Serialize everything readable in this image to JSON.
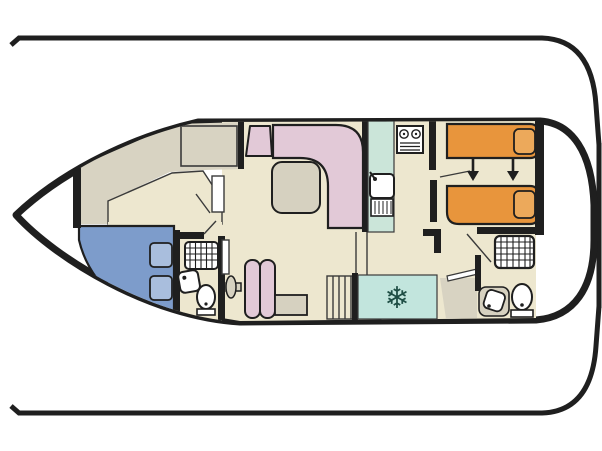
{
  "title": "boat-floor-plan",
  "colors": {
    "outline": "#1f1f1f",
    "wall": "#1f1f1f",
    "floor_cream": "#EDE7CF",
    "floor_grey": "#D8D3C2",
    "furniture_grey": "#D6D1C0",
    "bed_blue": "#7D9CCB",
    "pillow_blue": "#A9BEDD",
    "sofa_pink": "#E2C9D7",
    "bed_orange": "#E8953C",
    "pillow_orange": "#ECA95B",
    "galley_mint": "#CBE5D9",
    "fridge_cyan": "#C2E5DD",
    "snowflake_teal": "#1E4D44",
    "fixture_white": "#FFFFFF",
    "thin_line": "#3a3a3a"
  },
  "icons": {
    "snowflake": "❄"
  },
  "plan": {
    "bow_direction": "left",
    "deck_lines": 2,
    "arrow_count": 2,
    "rooms": [
      {
        "name": "bow-deck"
      },
      {
        "name": "forward-cabin",
        "features": [
          "double-bed",
          "wardrobe"
        ]
      },
      {
        "name": "forward-bathroom",
        "features": [
          "shower",
          "sink",
          "toilet"
        ]
      },
      {
        "name": "saloon",
        "features": [
          "l-shaped-sofa",
          "corner-seat",
          "table",
          "chair",
          "side-table"
        ]
      },
      {
        "name": "galley",
        "features": [
          "sink",
          "drainer",
          "stove",
          "fridge"
        ]
      },
      {
        "name": "aft-cabin",
        "features": [
          "twin-bed",
          "twin-bed"
        ]
      },
      {
        "name": "aft-bathroom",
        "features": [
          "shower",
          "sink",
          "toilet"
        ]
      },
      {
        "name": "stern-deck",
        "features": [
          "steps"
        ]
      }
    ]
  }
}
